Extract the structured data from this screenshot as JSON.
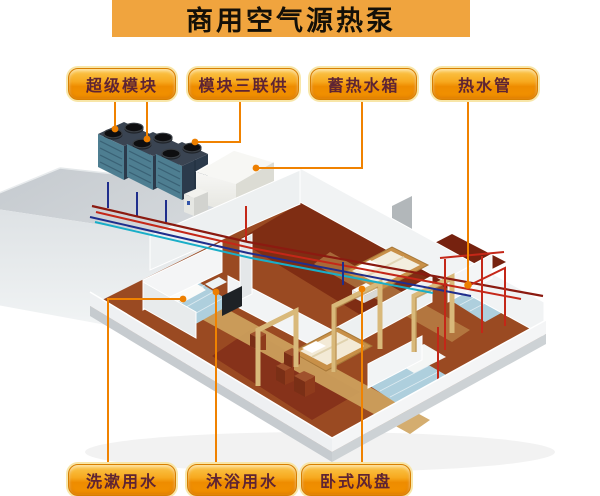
{
  "title": "商用空气源热泵",
  "callouts": {
    "top": [
      {
        "label": "超级模块"
      },
      {
        "label": "模块三联供"
      },
      {
        "label": "蓄热水箱"
      },
      {
        "label": "热水管"
      }
    ],
    "bottom": [
      {
        "label": "洗漱用水"
      },
      {
        "label": "沐浴用水"
      },
      {
        "label": "卧式风盘"
      }
    ]
  },
  "colors": {
    "title_bg": "#F0A43E",
    "callout_gradient_top": "#FBC84E",
    "callout_gradient_bottom": "#EE8C00",
    "callout_text": "#5E2433",
    "connector_line": "#F08200",
    "pipe_hot_red": "#C42718",
    "pipe_dark_red": "#8B1A10",
    "pipe_cold_blue": "#1F2E8C",
    "pipe_cyan": "#19AEC8",
    "roof_gray": "#CBD0D4",
    "floor_wood": "#9A4A22",
    "bathroom_tile": "#AECFDD"
  }
}
